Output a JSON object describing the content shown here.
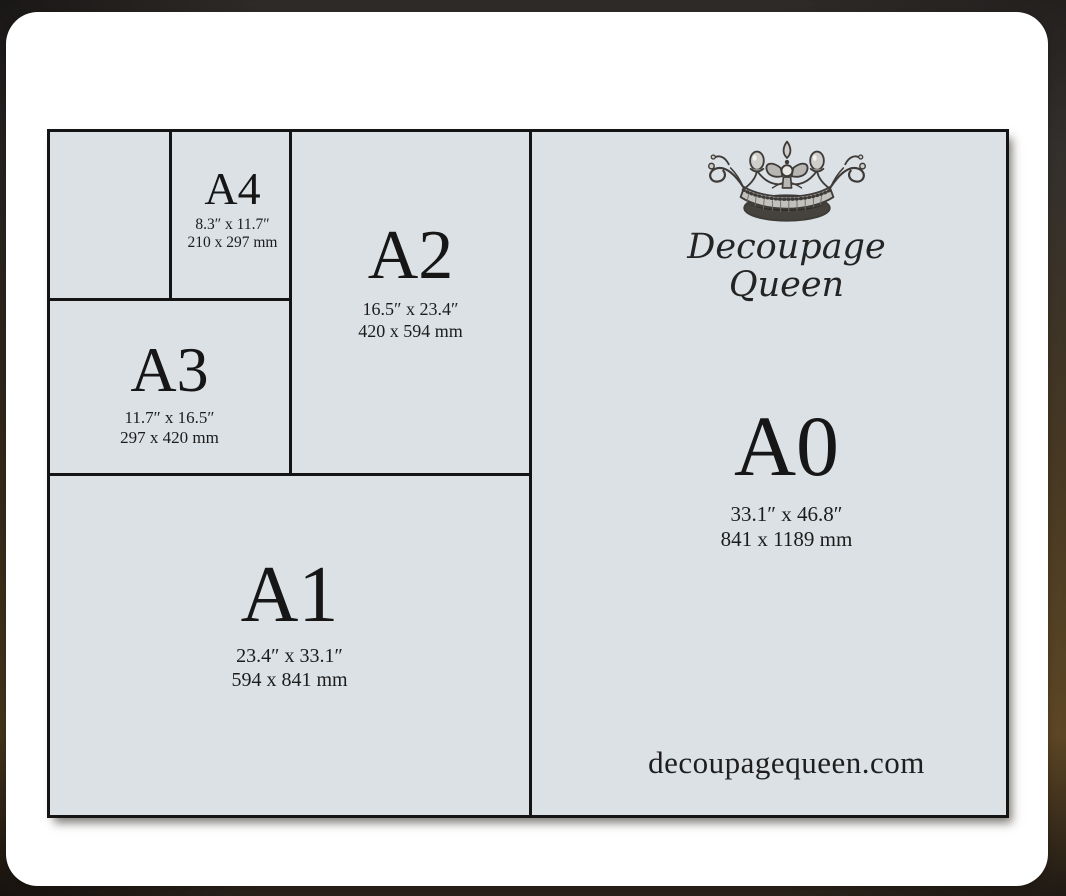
{
  "brand": {
    "line1": "Decoupage",
    "line2": "Queen",
    "website": "decoupagequeen.com"
  },
  "diagram": {
    "title_note": "A-series paper size comparison",
    "sizes": [
      {
        "label": "A4",
        "inches": "8.3″ x 11.7″",
        "mm": "210 x 297 mm"
      },
      {
        "label": "A3",
        "inches": "11.7″ x 16.5″",
        "mm": "297 x 420 mm"
      },
      {
        "label": "A2",
        "inches": "16.5″ x 23.4″",
        "mm": "420 x 594 mm"
      },
      {
        "label": "A1",
        "inches": "23.4″ x 33.1″",
        "mm": "594 x 841 mm"
      },
      {
        "label": "A0",
        "inches": "33.1″ x 46.8″",
        "mm": "841 x 1189 mm"
      }
    ],
    "colors": {
      "paper_fill": "#dbe1e5",
      "line_color": "#141414",
      "text_color": "#1a1a1a",
      "card_background": "#ffffff"
    }
  }
}
